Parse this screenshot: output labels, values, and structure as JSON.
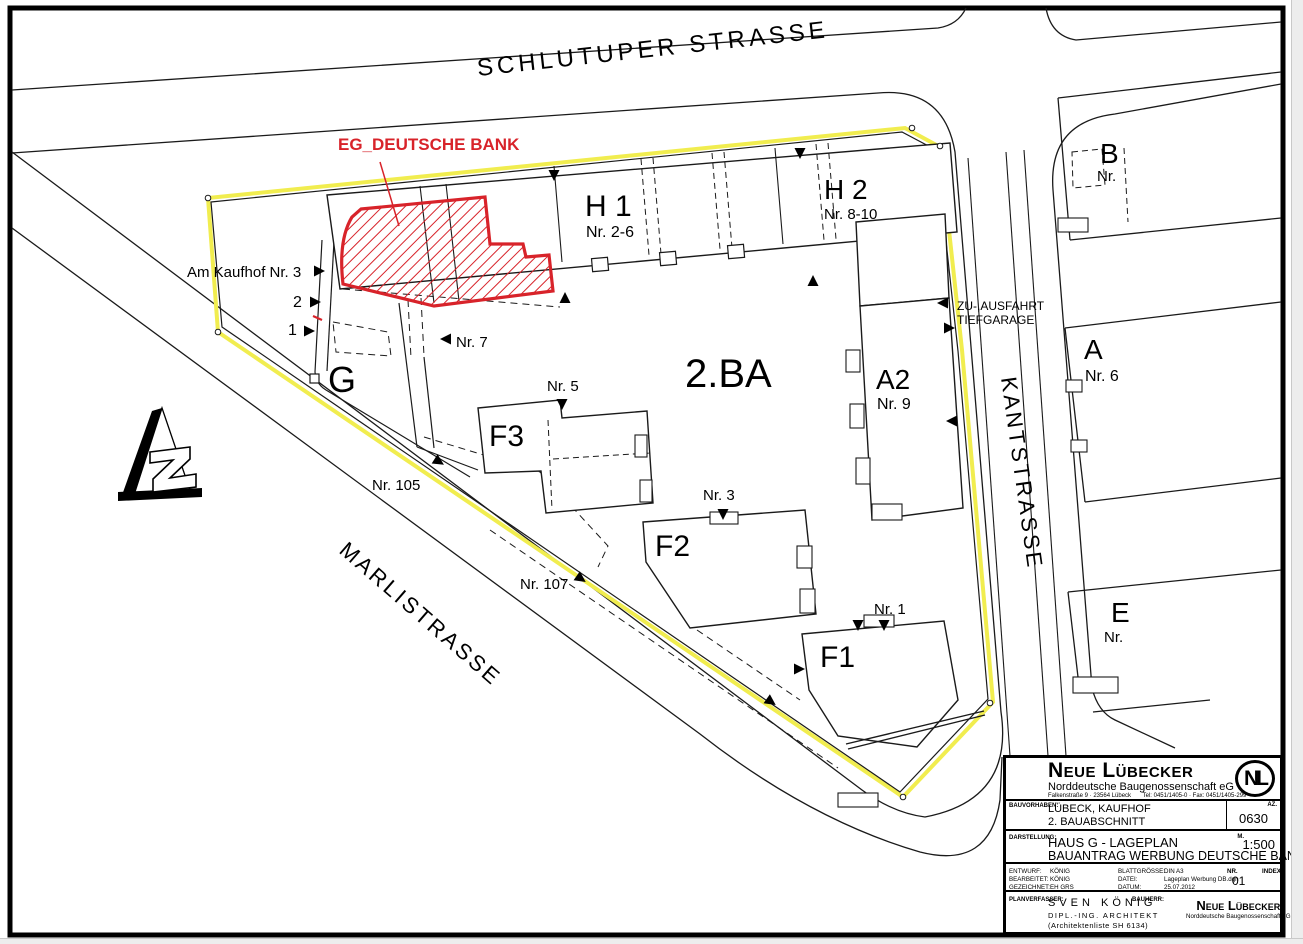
{
  "colors": {
    "boundary_yellow": "#f1ed4f",
    "bank_red": "#d8232a",
    "line_black": "#1a1a1a"
  },
  "plan": {
    "streets": {
      "schlutuper": "SCHLUTUPER  STRASSE",
      "marli": "MARLISTRASSE",
      "kant": "KANTSTRASSE"
    },
    "bank_label": "EG_DEUTSCHE BANK",
    "area_label": "2.BA",
    "buildings": {
      "h1": "H 1",
      "h1_nr": "Nr. 2-6",
      "h2": "H 2",
      "h2_nr": "Nr. 8-10",
      "a2": "A2",
      "a2_nr": "Nr. 9",
      "g": "G",
      "f1": "F1",
      "f2": "F2",
      "f3": "F3",
      "a": "A",
      "a_nr": "Nr. 6",
      "b": "B",
      "b_nr": "Nr.",
      "e": "E",
      "e_nr": "Nr."
    },
    "annotations": {
      "am_kaufhof": "Am Kaufhof Nr. 3",
      "no_2": "2",
      "no_1": "1",
      "nr7": "Nr. 7",
      "nr5": "Nr. 5",
      "nr3": "Nr. 3",
      "nr1": "Nr. 1",
      "nr105": "Nr. 105",
      "nr107": "Nr. 107",
      "garage_line1": "ZU-,AUSFAHRT",
      "garage_line2": "TIEFGARAGE"
    }
  },
  "titleblock": {
    "company": "Neue Lübecker",
    "company_sub": "Norddeutsche Baugenossenschaft eG",
    "company_address": "Falkenstraße 9 · 23564 Lübeck",
    "company_phone": "Tel: 0451/1405-0 · Fax: 0451/1405-299",
    "logo": "NL",
    "bauvorhaben_label": "BAUVORHABEN:",
    "bauvorhaben_line1": "LÜBECK, KAUFHOF",
    "bauvorhaben_line2": "2. BAUABSCHNITT",
    "az_label": "AZ.",
    "az_value": "0630",
    "darstellung_label": "DARSTELLUNG:",
    "darstellung_line1": "HAUS G - LAGEPLAN",
    "darstellung_line2": "BAUANTRAG  WERBUNG DEUTSCHE BANK",
    "m_label": "M.",
    "m_value": "1:500",
    "entwurf_label": "ENTWURF:",
    "entwurf": "KÖNIG",
    "bearbeitet_label": "BEARBEITET:",
    "bearbeitet": "KÖNIG",
    "gezeichnet_label": "GEZEICHNET:",
    "gezeichnet": "EH GRS",
    "blattgroesse_label": "BLATTGRÖSSE:",
    "blattgroesse": "DIN A3",
    "datei_label": "DATEI:",
    "datei": "Lageplan Werbung DB.dgn",
    "datum_label": "DATUM:",
    "datum": "25.07.2012",
    "nr_label": "NR.",
    "nr_value": "01",
    "index_label": "INDEX",
    "planverfasser_label": "PLANVERFASSER:",
    "planverfasser_line1": "SVEN  KÖNIG",
    "planverfasser_line2": "DIPL.-ING.  ARCHITEKT",
    "planverfasser_line3": "(Architektenliste  SH 6134)",
    "bauherr_label": "BAUHERR:",
    "bauherr_line1": "Neue Lübecker",
    "bauherr_line2": "Norddeutsche Baugenossenschaft eG"
  }
}
